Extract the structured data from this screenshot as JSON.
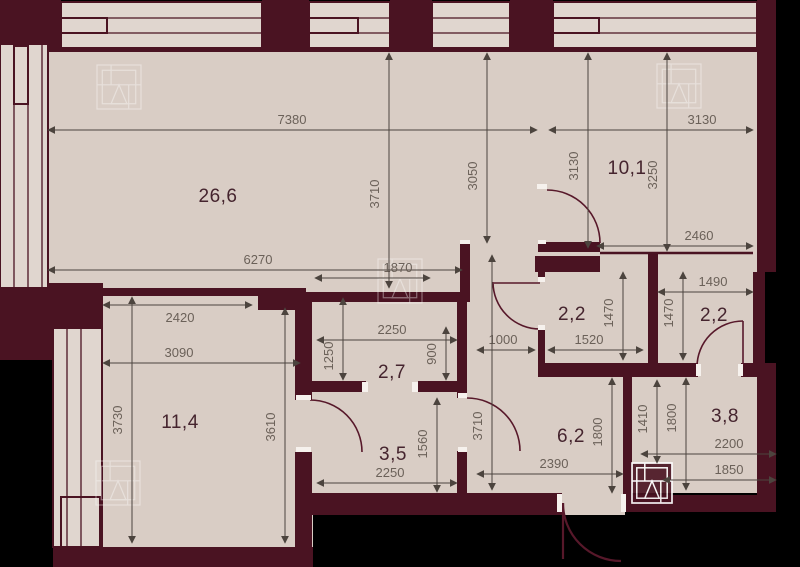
{
  "meta": {
    "type": "apartment-floor-plan",
    "units": "mm"
  },
  "colors": {
    "background": "#000000",
    "wall": "#4a1322",
    "floor": "#d9cdc5",
    "window_fill": "#e0d6cf",
    "dim_line": "#4c443e",
    "dim_text": "#6b6159",
    "room_text": "#45242e",
    "jamb_white": "#f6f1ed"
  },
  "rooms": [
    {
      "name": "living-room",
      "area": "26,6",
      "x": 218,
      "y": 202
    },
    {
      "name": "bedroom-2",
      "area": "10,1",
      "x": 627,
      "y": 174
    },
    {
      "name": "bedroom-1",
      "area": "11,4",
      "x": 180,
      "y": 428
    },
    {
      "name": "hall-middle",
      "area": "2,7",
      "x": 392,
      "y": 378
    },
    {
      "name": "corridor",
      "area": "3,5",
      "x": 393,
      "y": 460
    },
    {
      "name": "bathroom-left",
      "area": "2,2",
      "x": 572,
      "y": 320
    },
    {
      "name": "bathroom-right",
      "area": "2,2",
      "x": 714,
      "y": 321
    },
    {
      "name": "entrance-hall",
      "area": "6,2",
      "x": 571,
      "y": 442
    },
    {
      "name": "storage",
      "area": "3,8",
      "x": 725,
      "y": 422
    }
  ],
  "dimensions_h": [
    {
      "v": "7380",
      "x1": 48,
      "x2": 537,
      "y": 130,
      "lx": 292,
      "ly": 124
    },
    {
      "v": "3130",
      "x1": 549,
      "x2": 753,
      "y": 130,
      "lx": 702,
      "ly": 124
    },
    {
      "v": "6270",
      "x1": 48,
      "x2": 462,
      "y": 270,
      "lx": 258,
      "ly": 264
    },
    {
      "v": "2460",
      "x1": 597,
      "x2": 753,
      "y": 246,
      "lx": 699,
      "ly": 240
    },
    {
      "v": "1490",
      "x1": 658,
      "x2": 753,
      "y": 292,
      "lx": 713,
      "ly": 286
    },
    {
      "v": "2420",
      "x1": 103,
      "x2": 252,
      "y": 305,
      "lx": 180,
      "ly": 322
    },
    {
      "v": "3090",
      "x1": 103,
      "x2": 300,
      "y": 363,
      "lx": 179,
      "ly": 357
    },
    {
      "v": "1870",
      "x1": 315,
      "x2": 430,
      "y": 278,
      "lx": 398,
      "ly": 272
    },
    {
      "v": "2250",
      "x1": 317,
      "x2": 457,
      "y": 340,
      "lx": 392,
      "ly": 334
    },
    {
      "v": "1000",
      "x1": 477,
      "x2": 535,
      "y": 350,
      "lx": 503,
      "ly": 344
    },
    {
      "v": "1520",
      "x1": 548,
      "x2": 643,
      "y": 350,
      "lx": 589,
      "ly": 344
    },
    {
      "v": "2390",
      "x1": 477,
      "x2": 623,
      "y": 474,
      "lx": 554,
      "ly": 468
    },
    {
      "v": "2200",
      "x1": 641,
      "x2": 776,
      "y": 454,
      "lx": 729,
      "ly": 448
    },
    {
      "v": "1850",
      "x1": 663,
      "x2": 776,
      "y": 480,
      "lx": 729,
      "ly": 474
    },
    {
      "v": "2250",
      "x1": 317,
      "x2": 457,
      "y": 483,
      "lx": 390,
      "ly": 477
    }
  ],
  "dimensions_v": [
    {
      "v": "3710",
      "y1": 53,
      "y2": 288,
      "x": 389,
      "lx": 379,
      "ly": 194
    },
    {
      "v": "3050",
      "y1": 53,
      "y2": 243,
      "x": 487,
      "lx": 477,
      "ly": 176
    },
    {
      "v": "3130",
      "y1": 53,
      "y2": 248,
      "x": 588,
      "lx": 578,
      "ly": 166
    },
    {
      "v": "3250",
      "y1": 53,
      "y2": 251,
      "x": 667,
      "lx": 657,
      "ly": 175
    },
    {
      "v": "3730",
      "y1": 297,
      "y2": 543,
      "x": 132,
      "lx": 122,
      "ly": 420
    },
    {
      "v": "3610",
      "y1": 308,
      "y2": 543,
      "x": 285,
      "lx": 275,
      "ly": 427
    },
    {
      "v": "1250",
      "y1": 298,
      "y2": 380,
      "x": 343,
      "lx": 333,
      "ly": 356
    },
    {
      "v": "900",
      "y1": 327,
      "y2": 380,
      "x": 446,
      "lx": 436,
      "ly": 354
    },
    {
      "v": "1470",
      "y1": 272,
      "y2": 360,
      "x": 623,
      "lx": 613,
      "ly": 313
    },
    {
      "v": "1470",
      "y1": 272,
      "y2": 360,
      "x": 683,
      "lx": 673,
      "ly": 313
    },
    {
      "v": "1800",
      "y1": 378,
      "y2": 493,
      "x": 612,
      "lx": 602,
      "ly": 432
    },
    {
      "v": "1410",
      "y1": 380,
      "y2": 463,
      "x": 657,
      "lx": 647,
      "ly": 419
    },
    {
      "v": "1800",
      "y1": 378,
      "y2": 490,
      "x": 686,
      "lx": 676,
      "ly": 418
    },
    {
      "v": "1560",
      "y1": 398,
      "y2": 492,
      "x": 437,
      "lx": 427,
      "ly": 444
    },
    {
      "v": "3710",
      "y1": 255,
      "y2": 490,
      "x": 492,
      "lx": 482,
      "ly": 426
    }
  ],
  "logos": [
    {
      "x": 97,
      "y": 65,
      "s": 44,
      "variant": "watermark"
    },
    {
      "x": 657,
      "y": 64,
      "s": 44,
      "variant": "watermark"
    },
    {
      "x": 378,
      "y": 259,
      "s": 44,
      "variant": "watermark"
    },
    {
      "x": 96,
      "y": 461,
      "s": 44,
      "variant": "watermark"
    },
    {
      "x": 632,
      "y": 463,
      "s": 40,
      "variant": "shaft"
    }
  ]
}
